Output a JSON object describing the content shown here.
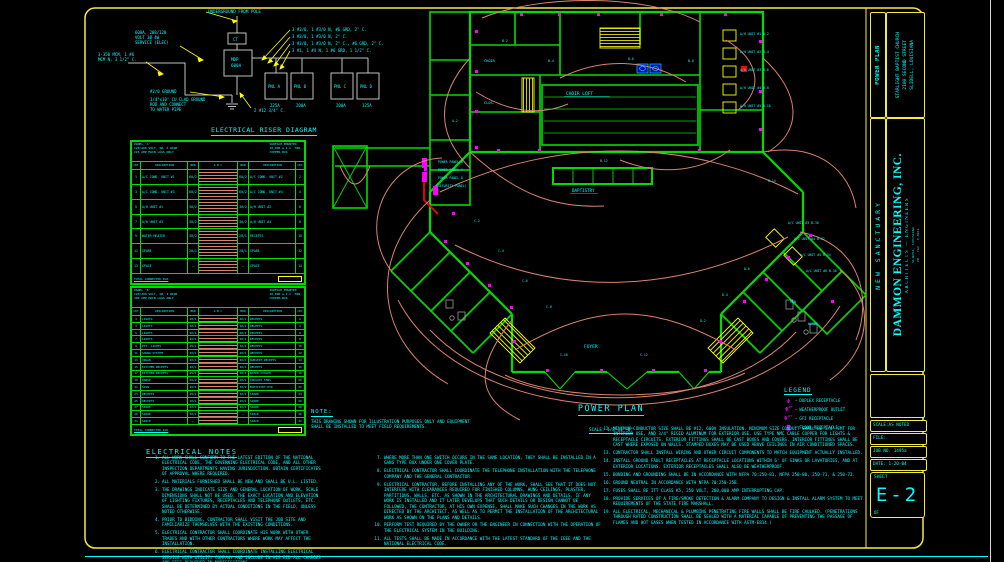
{
  "riser": {
    "title": "ELECTRICAL RISER DIAGRAM",
    "scale": "SCALE: 1/8\"=1'-0\"",
    "underground": "UNDERGROUND FROM POLE",
    "service": [
      "600A, 208/120",
      "VOLT 3Ø 4W",
      "SERVICE (ELEC)"
    ],
    "feeder": [
      "3-350 MCM, 1 #6",
      "MCM N, 3 1/2\" C."
    ],
    "ground1": "#2/0 GROUND",
    "ground2": [
      "3/4\"x10' CU CLAD GROUND",
      "ROD AND CONNECT",
      "TO WATER PIPE"
    ],
    "c2": "2 #12 3/4\" C.",
    "ct": "CT",
    "mdp": [
      "MDP",
      "600A"
    ],
    "callouts": [
      "3 #3/0, 1 #3/0 N, #6 GRD, 2\" C.",
      "3 #3/0, 1 #3/0 N, 2\" C.",
      "3 #3/0, 1 #3/0 N, 2\" C., #6 GRD, 2\" C.",
      "3 #1, 1 #4 N, 1 #6 GRD, 1 1/2\" C."
    ],
    "panels": [
      {
        "n": "PNL A",
        "a": "225A"
      },
      {
        "n": "PNL B",
        "a": "200A"
      },
      {
        "n": "PNL C",
        "a": "200A"
      },
      {
        "n": "PNL D",
        "a": "125A"
      }
    ]
  },
  "schedules": {
    "cols": [
      "CKT",
      "DESCRIPTION",
      "BKR",
      "A   B   C",
      "BKR",
      "DESCRIPTION",
      "CKT"
    ],
    "a": {
      "hl": [
        "PANEL 'A'",
        "120/208 VOLT, 3Ø, 4 WIRE",
        "225 AMP MAIN LUGS ONLY"
      ],
      "hr": [
        "SURFACE MOUNTED",
        "10,000 A.I.C. MIN.",
        "COPPER BUS"
      ],
      "fl": "TOTAL CONNECTED KVA",
      "rows": [
        {
          "lc": "1",
          "ld": "A/C COND. UNIT #1",
          "lb": "60/2",
          "rb": "60/2",
          "rd": "A/C COND. UNIT #2",
          "rc": "2"
        },
        {
          "lc": "3",
          "ld": "A/C COND. UNIT #3",
          "lb": "60/2",
          "rb": "60/2",
          "rd": "A/C COND. UNIT #4",
          "rc": "4"
        },
        {
          "lc": "5",
          "ld": "A/H UNIT #1",
          "lb": "30/2",
          "rb": "30/2",
          "rd": "A/H UNIT #2",
          "rc": "6"
        },
        {
          "lc": "7",
          "ld": "A/H UNIT #3",
          "lb": "30/2",
          "rb": "30/2",
          "rd": "A/H UNIT #4",
          "rc": "8"
        },
        {
          "lc": "9",
          "ld": "WATER HEATER",
          "lb": "30/2",
          "rb": "20/1",
          "rd": "RECEPTS",
          "rc": "10"
        },
        {
          "lc": "11",
          "ld": "SPARE",
          "lb": "20/1",
          "rb": "20/1",
          "rd": "SPARE",
          "rc": "12"
        },
        {
          "lc": "13",
          "ld": "SPACE",
          "lb": "—",
          "rb": "—",
          "rd": "SPACE",
          "rc": "14"
        }
      ]
    },
    "b": {
      "hl": [
        "PANEL 'B'",
        "120/208 VOLT, 3Ø, 4 WIRE",
        "200 AMP MAIN LUGS ONLY"
      ],
      "hr": [
        "SURFACE MOUNTED",
        "10,000 A.I.C. MIN.",
        "COPPER BUS"
      ],
      "fl": "TOTAL CONNECTED KVA",
      "rows": [
        {
          "lc": "1",
          "ld": "LIGHTS",
          "lb": "20/1",
          "rb": "20/1",
          "rd": "RECEPTS",
          "rc": "2"
        },
        {
          "lc": "3",
          "ld": "LIGHTS",
          "lb": "20/1",
          "rb": "20/1",
          "rd": "RECEPTS",
          "rc": "4"
        },
        {
          "lc": "5",
          "ld": "LIGHTS",
          "lb": "20/1",
          "rb": "20/1",
          "rd": "RECEPTS",
          "rc": "6"
        },
        {
          "lc": "7",
          "ld": "LIGHTS",
          "lb": "20/1",
          "rb": "20/1",
          "rd": "RECEPTS",
          "rc": "8"
        },
        {
          "lc": "9",
          "ld": "EXT. LIGHTS",
          "lb": "20/1",
          "rb": "20/1",
          "rd": "RECEPTS",
          "rc": "10"
        },
        {
          "lc": "11",
          "ld": "SOUND SYSTEM",
          "lb": "20/1",
          "rb": "20/1",
          "rd": "RECEPTS",
          "rc": "12"
        },
        {
          "lc": "13",
          "ld": "ORGAN",
          "lb": "20/1",
          "rb": "20/1",
          "rd": "NURSERY RECEPTS",
          "rc": "14"
        },
        {
          "lc": "15",
          "ld": "KITCHEN RECEPTS",
          "lb": "20/1",
          "rb": "20/1",
          "rd": "RECEPTS",
          "rc": "16"
        },
        {
          "lc": "17",
          "ld": "KITCHEN RECEPTS",
          "lb": "20/1",
          "rb": "20/1",
          "rd": "WATER COOLER",
          "rc": "18"
        },
        {
          "lc": "19",
          "ld": "RANGE",
          "lb": "50/2",
          "rb": "20/1",
          "rd": "EXHAUST FANS",
          "rc": "20"
        },
        {
          "lc": "21",
          "ld": "SIGN",
          "lb": "20/1",
          "rb": "30/2",
          "rd": "BAPTISTRY HTR",
          "rc": "22"
        },
        {
          "lc": "23",
          "ld": "RECEPTS",
          "lb": "20/1",
          "rb": "20/1",
          "rd": "SPARE",
          "rc": "24"
        },
        {
          "lc": "25",
          "ld": "RECEPTS",
          "lb": "20/1",
          "rb": "20/1",
          "rd": "SPARE",
          "rc": "26"
        },
        {
          "lc": "27",
          "ld": "SPARE",
          "lb": "20/1",
          "rb": "20/1",
          "rd": "SPARE",
          "rc": "28"
        },
        {
          "lc": "29",
          "ld": "SPARE",
          "lb": "20/1",
          "rb": "—",
          "rd": "SPACE",
          "rc": "30"
        },
        {
          "lc": "31",
          "ld": "SPACE",
          "lb": "—",
          "rb": "—",
          "rd": "SPACE",
          "rc": "32"
        }
      ]
    }
  },
  "notes": {
    "title": "ELECTRICAL NOTES",
    "col1": [
      {
        "n": "1.",
        "t": "ALL WORK SHALL CONFORM TO THE LATEST EDITION OF THE NATIONAL ELECTRICAL CODE, THE GOVERNING ELECTRICAL CODE, AND ALL OTHER INSPECTION DEPARTMENTS HAVING JURISDICTION. OBTAIN CERTIFICATES OF APPROVAL WHERE REQUIRED."
      },
      {
        "n": "2.",
        "t": "ALL MATERIALS FURNISHED SHALL BE NEW AND SHALL BE U.L. LISTED."
      },
      {
        "n": "3.",
        "t": "THE DRAWINGS INDICATE SIZE AND GENERAL LOCATION OF WORK. SCALE DIMENSIONS SHALL NOT BE USED. THE EXACT LOCATION AND ELEVATION OF LIGHTING FIXTURES, RECEPTACLES AND TELEPHONE OUTLETS, ETC. SHALL BE DETERMINED BY ACTUAL CONDITIONS IN THE FIELD, UNLESS NOTED OTHERWISE."
      },
      {
        "n": "4.",
        "t": "PRIOR TO BIDDING, CONTRACTOR SHALL VISIT THE JOB SITE AND FAMILIARIZE THEMSELVES WITH THE EXISTING CONDITIONS."
      },
      {
        "n": "5.",
        "t": "ELECTRICAL CONTRACTOR SHALL COORDINATE HIS WORK WITH OTHER TRADES AND WITH OTHER CONTRACTORS WHERE WORK MAY AFFECT THE INSTALLATION."
      },
      {
        "n": "6.",
        "t": "ELECTRICAL CONTRACTOR SHALL COORDINATE INSTALLING ELECTRICAL SERVICE WITH UTILITY COMPANY AND INCLUDE IN HIS BID ALL CHARGES AND FEES REQUIRED IN MODIFICATIONS."
      }
    ],
    "col2": [
      {
        "n": "7.",
        "t": "WHERE MORE THAN ONE SWITCH OCCURS IN THE SAME LOCATION, THEY SHALL BE INSTALLED IN A GANG TYPE BOX UNDER ONE COVER PLATE."
      },
      {
        "n": "8.",
        "t": "ELECTRICAL CONTRACTOR SHALL COORDINATE THE TELEPHONE INSTALLATION WITH THE TELEPHONE COMPANY AND THE GENERAL CONTRACTOR."
      },
      {
        "n": "9.",
        "t": "ELECTRICAL CONTRACTOR, BEFORE INSTALLING ANY OF THE WORK, SHALL SEE THAT IT DOES NOT INTERFERE WITH CLEARANCES REQUIRED FOR FINISHED COLUMNS, HUNG CEILINGS, PLASTER, PARTITIONS, WALLS, ETC. AS SHOWN IN THE ARCHITECTURAL DRAWINGS AND DETAILS. IF ANY WORK IS INSTALLED AND IT LATER DEVELOPS THAT SUCH DETAILS OR DESIGN CANNOT BE FOLLOWED, THE CONTRACTOR, AT HIS OWN EXPENSE, SHALL MAKE SUCH CHANGES IN THE WORK AS DIRECTED BY THE ARCHITECT, AS WELL AS TO PERMIT THE INSTALLATION OF THE ARCHITECTURAL WORK AS SHOWN ON THE PLANS AND DETAILS."
      },
      {
        "n": "10.",
        "t": "PERFORM TEST REQUIRED BY THE OWNER OR THE ENGINEER IN CONNECTION WITH THE OPERATION OF THE ELECTRICAL SYSTEM IN THE BUILDING."
      },
      {
        "n": "11.",
        "t": "ALL TESTS SHALL BE MADE IN ACCORDANCE WITH THE LATEST STANDARD OF THE IEEE AND THE NATIONAL ELECTRICAL CODE."
      }
    ],
    "col3": [
      {
        "n": "12.",
        "t": "MINIMUM CONDUCTOR SIZE SHALL BE #12, 600V INSULATION. MINIMUM SIZE CONDUIT SHALL BE 3/4\" EMT FOR INTERIOR USE, AND 3/4\" RIGID ALUMINUM FOR EXTERIOR USE. USE TYPE NMC CABLE COPPER FOR LIGHTS & RECEPTACLE CIRCUITS. EXTERIOR FITTINGS SHALL BE CAST BOXES AND COVERS. INTERIOR FITTINGS SHALL BE CAST WHERE EXPOSED ON WALLS. STAMPED BOXES MAY BE USED ABOVE CEILINGS IN AIR CONDITIONED SPACES."
      },
      {
        "n": "13.",
        "t": "CONTRACTOR SHALL INSTALL WIRING AND OTHER CIRCUIT COMPONENTS TO MATCH EQUIPMENT ACTUALLY INSTALLED."
      },
      {
        "n": "14.",
        "t": "INSTALL GROUND FAULT RECEPTACLES AT RECEPTACLE LOCATIONS WITHIN 6' OF SINKS OR LAVATORIES, AND AT EXTERIOR LOCATIONS. EXTERIOR RECEPTACLES SHALL ALSO BE WEATHERPROOF."
      },
      {
        "n": "15.",
        "t": "BONDING AND GROUNDING SHALL BE IN ACCORDANCE WITH NFPA 70:250-81, NFPA 250-80, 250-71, & 250-72."
      },
      {
        "n": "16.",
        "t": "GROUND NEUTRAL IN ACCORDANCE WITH NFPA 70:250-25B."
      },
      {
        "n": "17.",
        "t": "FUSES SHALL BE ITT CLASS K5, 250 VOLT, 200,000 AMP INTERRUPTING CAP."
      },
      {
        "n": "18.",
        "t": "PROVIDE SERVICES OF A FIRE/SMOKE DETECTION & ALARM COMPANY TO DESIGN & INSTALL ALARM SYSTEM TO MEET REQUIREMENTS OF THE STATE FIRE MARSHALL."
      },
      {
        "n": "19.",
        "t": "ALL ELECTRICAL, MECHANICAL & PLUMBING PENETRATING FIRE WALLS SHALL BE FIRE CAULKED. (PENETRATIONS THROUGH RATED CONSTRUCTION SHALL BE SEALED WITH A MATERIAL CAPABLE OF PREVENTING THE PASSAGE OF FLAMES AND HOT GASES WHEN TESTED IN ACCORDANCE WITH ASTM-E814.)"
      }
    ]
  },
  "note_box": {
    "title": "NOTE:",
    "text": "THIS DRAWING SHOWN FOR ILLUSTRATION PURPOSES ONLY AND EQUIPMENT SHALL BE INSTALLED TO MEET FIELD REQUIREMENTS."
  },
  "legend": {
    "title": "LEGEND",
    "items": [
      {
        "s": "Φ",
        "sup": "",
        "l": "DUPLEX RECEPTACLE"
      },
      {
        "s": "Φ",
        "sup": "WP",
        "l": "WEATHERPROOF OUTLET"
      },
      {
        "s": "Φ",
        "sup": "GFI",
        "l": "GFI RECEPTACLE"
      },
      {
        "s": "◙",
        "sup": "",
        "l": "FLOOR RECEPTACLE"
      }
    ]
  },
  "plan": {
    "title": "POWER PLAN",
    "scale": "SCALE: 1/8\"=1'-0\"",
    "labels": [
      "CHOIR LOFT",
      "BAPTISTRY",
      "FOYER",
      "POWER PANEL B",
      "POWER PANEL C",
      "POWER PANEL D",
      "(SECURITY PANEL)",
      "A/H UNIT #1  B-2",
      "A/H UNIT #2  B-4",
      "A/H UNIT #3  B-6",
      "A/H UNIT #4  B-8",
      "A/H UNIT #5  B-10",
      "A/C UNIT #3  B-30",
      "A/C UNIT #4  B-32",
      "A/C UNIT #5  B-34",
      "A/C UNIT #6  B-36",
      "MEN",
      "WOMEN",
      "CHOIR",
      "CLOS.",
      "B-2",
      "B-4",
      "B-6",
      "B-8",
      "B-12",
      "C-2",
      "C-4",
      "C-6",
      "C-8",
      "D-2",
      "D-4",
      "D-6",
      "C-10",
      "C-12",
      "B-14",
      "A-2"
    ]
  },
  "titleblock": {
    "power_plan": "POWER PLAN",
    "project": [
      "STARLIGHT BAPTIST CHURCH",
      "2100 SECOND STREET",
      "SLIDELL, LOUISIANA"
    ],
    "new_sanctuary": "NEW SANCTUARY",
    "firm_name": "DAMMON ENGINEERING, INC.",
    "firm_sub": "ARCHITECTS — ENGINEERS",
    "firm_tiny1": "SLIDELL, LOUISIANA",
    "firm_tiny2": "PH · FAX · E-MAIL",
    "scale": "SCALE:AS NOTED",
    "file": "FILE:",
    "job": "JOB NO. 1495a",
    "date": "DATE: 1-20-04",
    "sheet_label": "SHEET",
    "sheet_no": "E-2",
    "of": "OF"
  }
}
